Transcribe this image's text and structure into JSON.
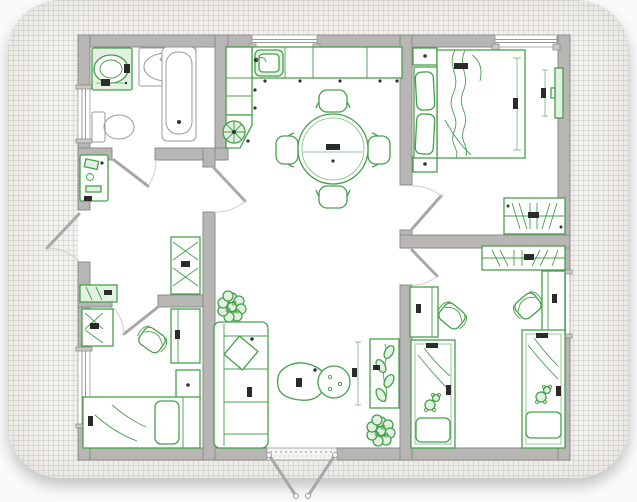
{
  "document": {
    "kind": "apartment-floor-plan-drawing",
    "style": "architect sketch on graph paper, rounded white card with shadow",
    "readable_text": "none (dimension labels are illegible micro-text smudges)"
  },
  "colors": {
    "furniture_green": "#44a04a",
    "furniture_green_fill": "#e3f1e3",
    "wall_fill": "#b7b6b4",
    "wall_edge": "#8d8c8a",
    "floor": "#ffffff",
    "paper": "#f2f1ed",
    "grid_line": "#bab8b0",
    "page_background": "#fbfafa",
    "dimension_label": "#2b2b2b"
  },
  "rooms": [
    {
      "id": "bathroom",
      "label": "Bathroom (top-left)",
      "furniture": [
        "washing machine",
        "wash basin",
        "bathtub",
        "toilet"
      ]
    },
    {
      "id": "hallway",
      "label": "Hallway (left-middle)",
      "furniture": [
        "console table",
        "wardrobe with hatching",
        "low sideboard",
        "entrance door opening outward"
      ]
    },
    {
      "id": "kitchen",
      "label": "Kitchen / dining (top-center)",
      "furniture": [
        "L-shaped counter",
        "kitchen sink",
        "corner unit with round hob-fan symbol",
        "round dining table",
        "4 dining chairs"
      ]
    },
    {
      "id": "living",
      "label": "Living room (bottom-center)",
      "furniture": [
        "3-seat sofa with diagonal cushion",
        "organic coffee table pair",
        "console with plant",
        "2 potted plants",
        "double french door to outside"
      ]
    },
    {
      "id": "master",
      "label": "Master bedroom (top-right)",
      "furniture": [
        "double bed with blanket sketch",
        "headboard with 2 pillows",
        "2 nightstands",
        "wall TV",
        "wardrobe with hanger hatching"
      ]
    },
    {
      "id": "bedroom2",
      "label": "Small bedroom (bottom-left)",
      "furniture": [
        "single bed with pillow",
        "wardrobe",
        "desk",
        "desk chair",
        "nightstand"
      ]
    },
    {
      "id": "kids",
      "label": "Kids room (bottom-right)",
      "furniture": [
        "single bed with teddy (left)",
        "single bed with teddy (right)",
        "2 desks",
        "2 desk chairs",
        "shared wardrobe with hanger hatching"
      ]
    }
  ],
  "openings": {
    "windows": [
      "top wall kitchen",
      "top wall master bedroom",
      "left wall bathroom",
      "left wall small bedroom",
      "right wall kids room"
    ],
    "doors": [
      "entrance (left wall, swings out)",
      "bathroom",
      "hall to kitchen",
      "small bedroom",
      "master bedroom",
      "kids room",
      "french double door (bottom, swings out)"
    ]
  },
  "dimension_marks": {
    "visible": true,
    "legible": false
  }
}
